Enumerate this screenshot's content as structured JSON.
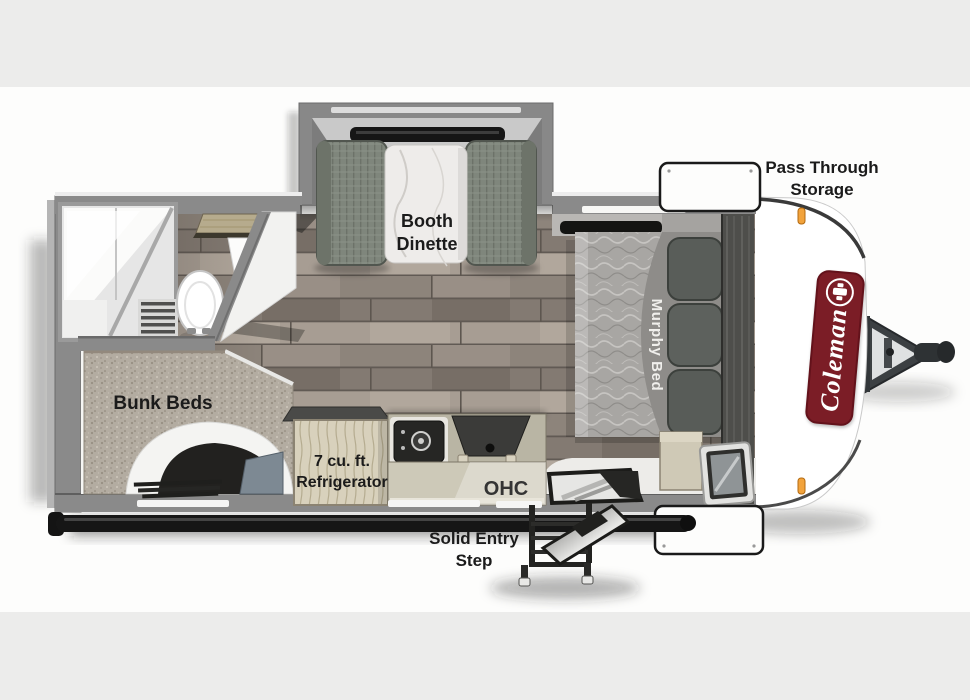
{
  "title": "Coleman Travel Trailer Floor Plan",
  "brand": {
    "name": "Coleman"
  },
  "labels": {
    "pass_through": {
      "line1": "Pass Through",
      "line2": "Storage"
    },
    "booth_dinette": {
      "line1": "Booth",
      "line2": "Dinette"
    },
    "murphy_bed": {
      "text": "Murphy Bed"
    },
    "bunk_beds": {
      "text": "Bunk Beds"
    },
    "refrigerator": {
      "line1": "7 cu. ft.",
      "line2": "Refrigerator"
    },
    "ohc": {
      "text": "OHC"
    },
    "entry_step": {
      "line1": "Solid Entry",
      "line2": "Step"
    }
  },
  "colors": {
    "background": "#fdfdfc",
    "band_gray": "#ececeb",
    "wall_gray": "#8a8a8a",
    "floor_wood": "#8d847b",
    "bunk_speckle": "#b3aca1",
    "bench_green": "#7f867c",
    "brand_red": "#7b1d26",
    "marker_orange": "#f2a33c",
    "label_text": "#1b1b1b"
  }
}
